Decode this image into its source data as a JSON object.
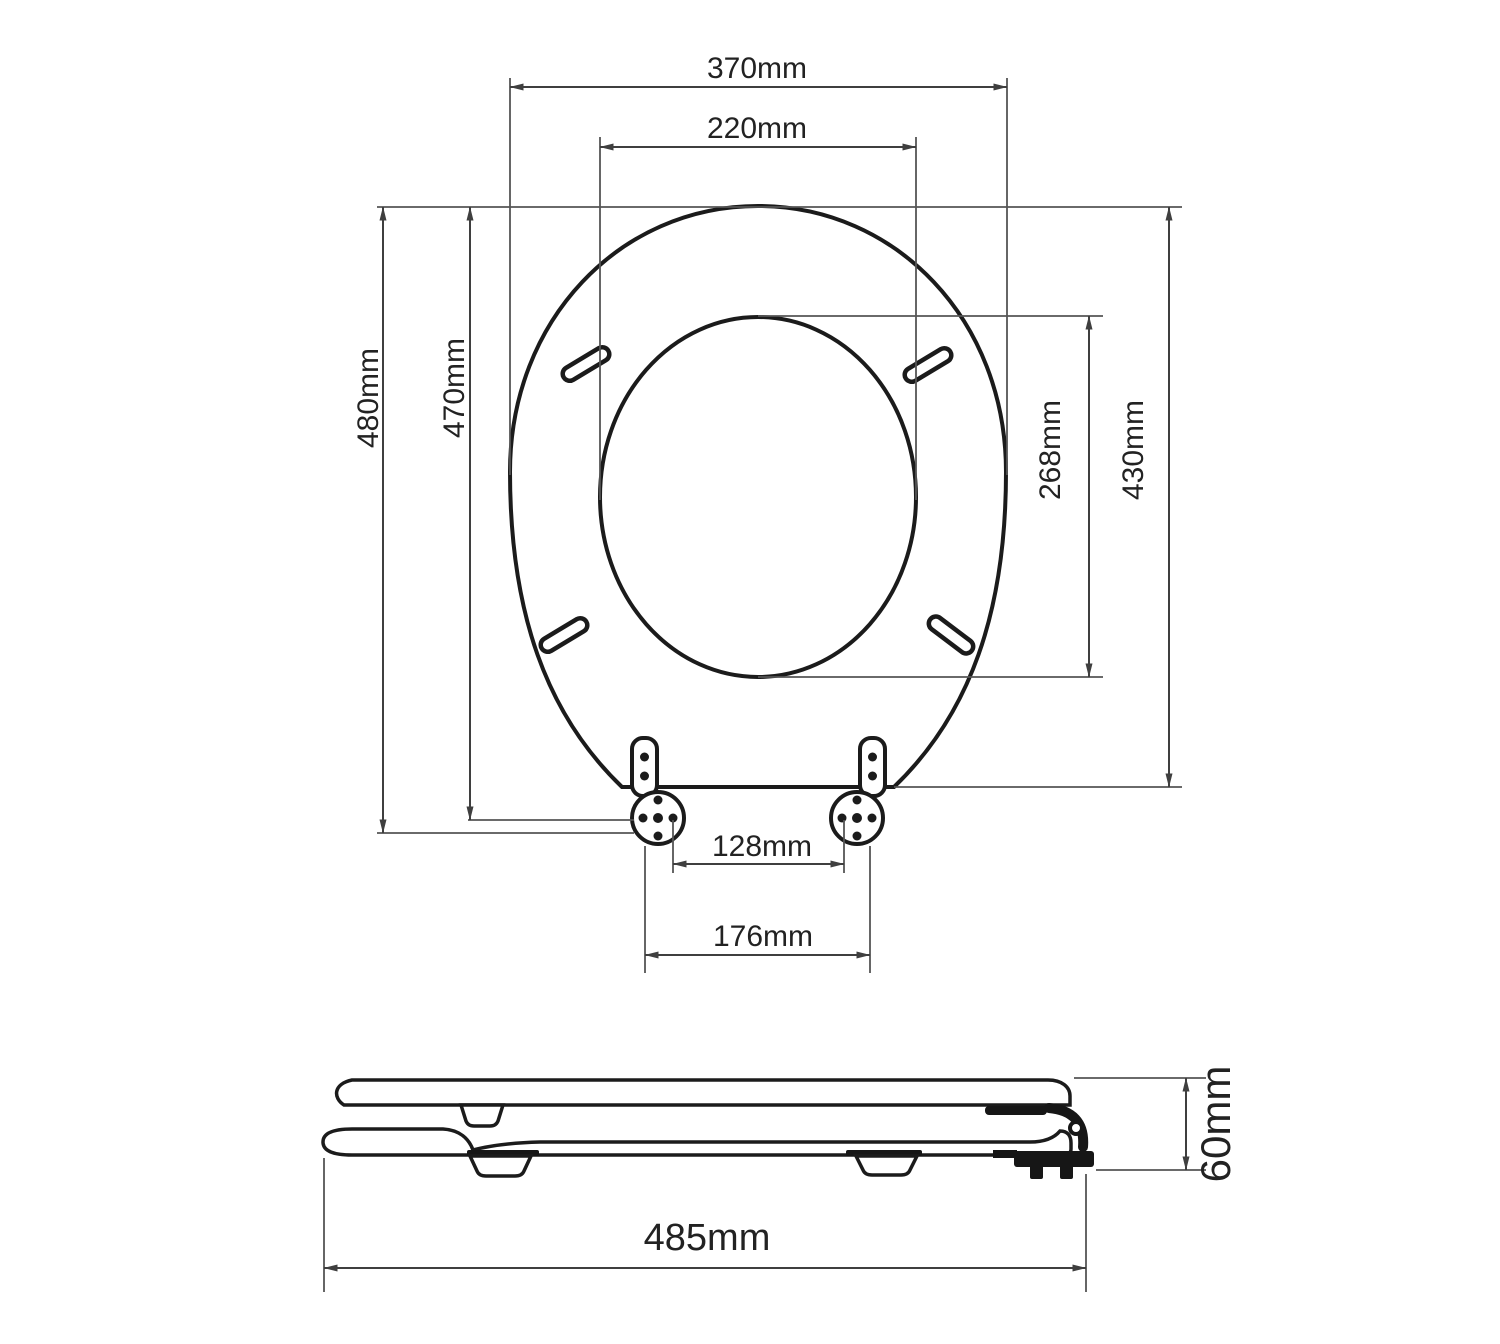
{
  "diagram": {
    "type": "technical-dimension-drawing",
    "subject": "toilet-seat-with-lid",
    "units": "mm",
    "colors": {
      "background": "#ffffff",
      "outline": "#1b1b1b",
      "dimension_line": "#3f3f3f",
      "extension_line": "#555555",
      "label_text": "#222222"
    },
    "dimensions": {
      "outer_width": "370mm",
      "inner_width": "220mm",
      "overall_length": "480mm",
      "length_to_hinge_axis": "470mm",
      "inner_cutout_length": "268mm",
      "seat_ring_length": "430mm",
      "hinge_bolt_spacing": "128mm",
      "hinge_outer_spacing": "176mm",
      "side_overall_length": "485mm",
      "side_height": "60mm"
    }
  }
}
